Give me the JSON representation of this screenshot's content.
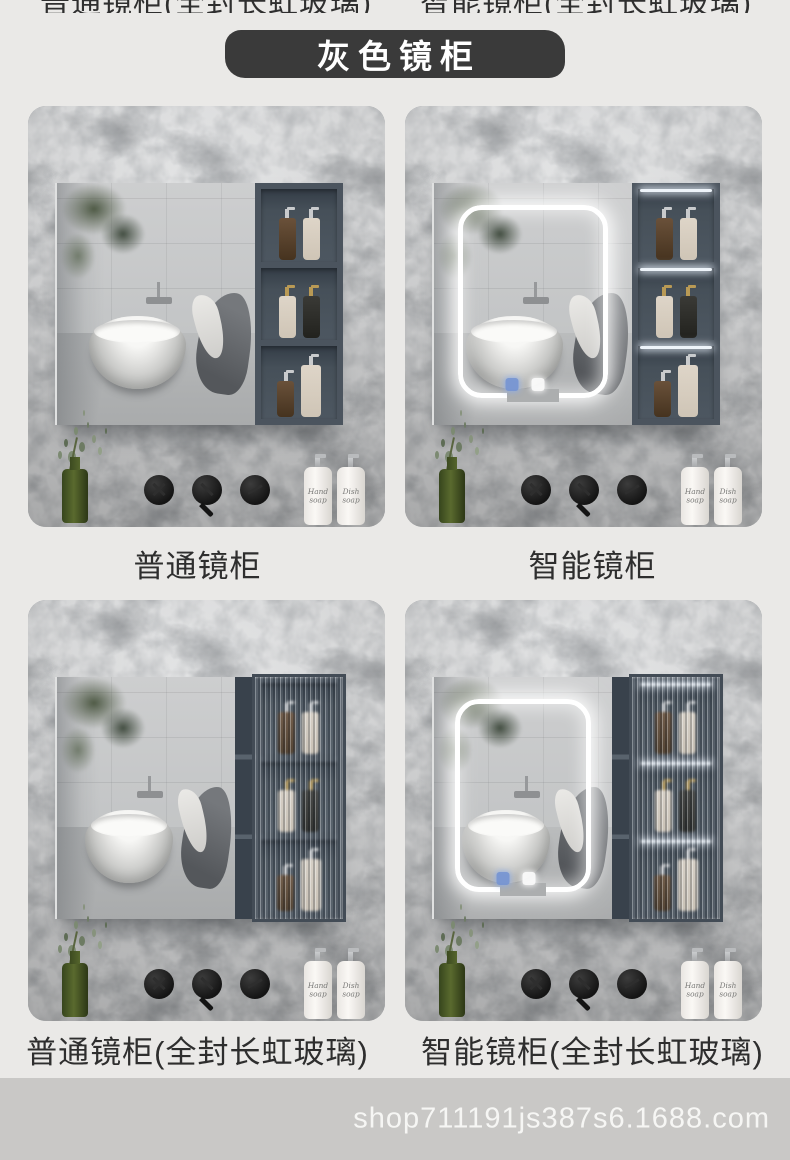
{
  "section_title": "灰色镜柜",
  "top_clipped": [
    "普通镜柜(全封长虹玻璃)",
    "智能镜柜(全封长虹玻璃)"
  ],
  "products": [
    {
      "label": "普通镜柜"
    },
    {
      "label": "智能镜柜"
    },
    {
      "label": "普通镜柜(全封长虹玻璃)"
    },
    {
      "label": "智能镜柜(全封长虹玻璃)"
    }
  ],
  "soap_bottles": {
    "hand": "Hand soap",
    "dish": "Dish soap"
  },
  "footer": {
    "url": "shop711191js387s6.1688.com"
  },
  "colors": {
    "page_bg": "#eae9e7",
    "badge_bg": "#3a3a3a",
    "badge_text": "#ffffff",
    "caption_text": "#2e2e2e",
    "marble_base": "#979a9d",
    "cabinet_frame": "#4b545e",
    "led_glow": "#ffffff",
    "touch_icon_blue": "#7494d4",
    "vase_green": "#4a5a26",
    "footer_band": "#c9c8c6",
    "footer_text": "#f6f6f4"
  }
}
